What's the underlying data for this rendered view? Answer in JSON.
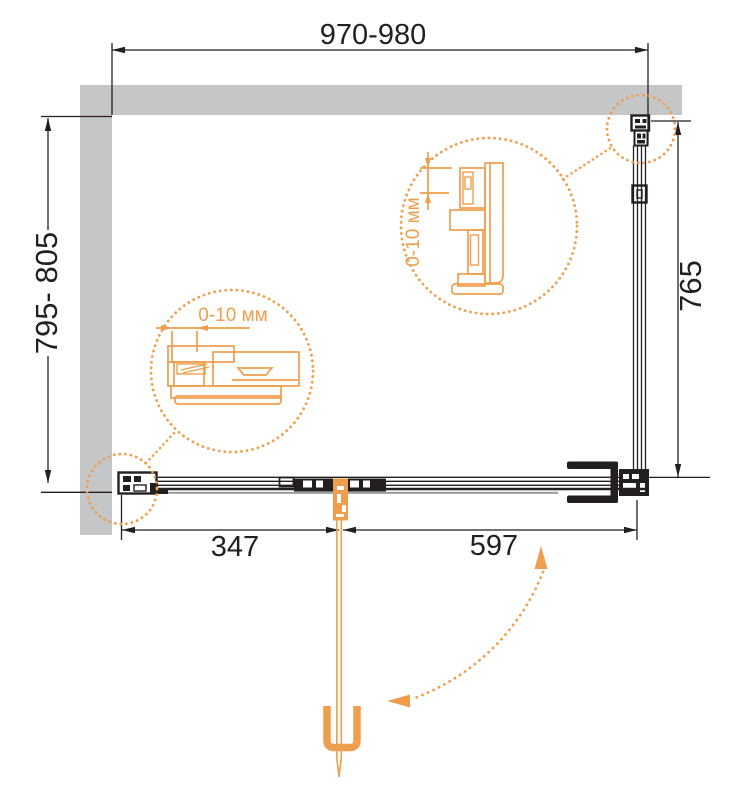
{
  "colors": {
    "background": "#FFFFFF",
    "wall_gray": "#C5C6C8",
    "line_black": "#231F20",
    "shadow_gray": "#9B9DA0",
    "accent_orange": "#EF9E4D"
  },
  "dimensions": {
    "top_width": "970-980",
    "left_depth": "795- 805",
    "right_glass_height": "765",
    "bottom_fixed_segment": "347",
    "bottom_door_segment": "597"
  },
  "details": {
    "left_callout_label": "0-10 мм",
    "right_callout_label": "0-10 мм"
  }
}
